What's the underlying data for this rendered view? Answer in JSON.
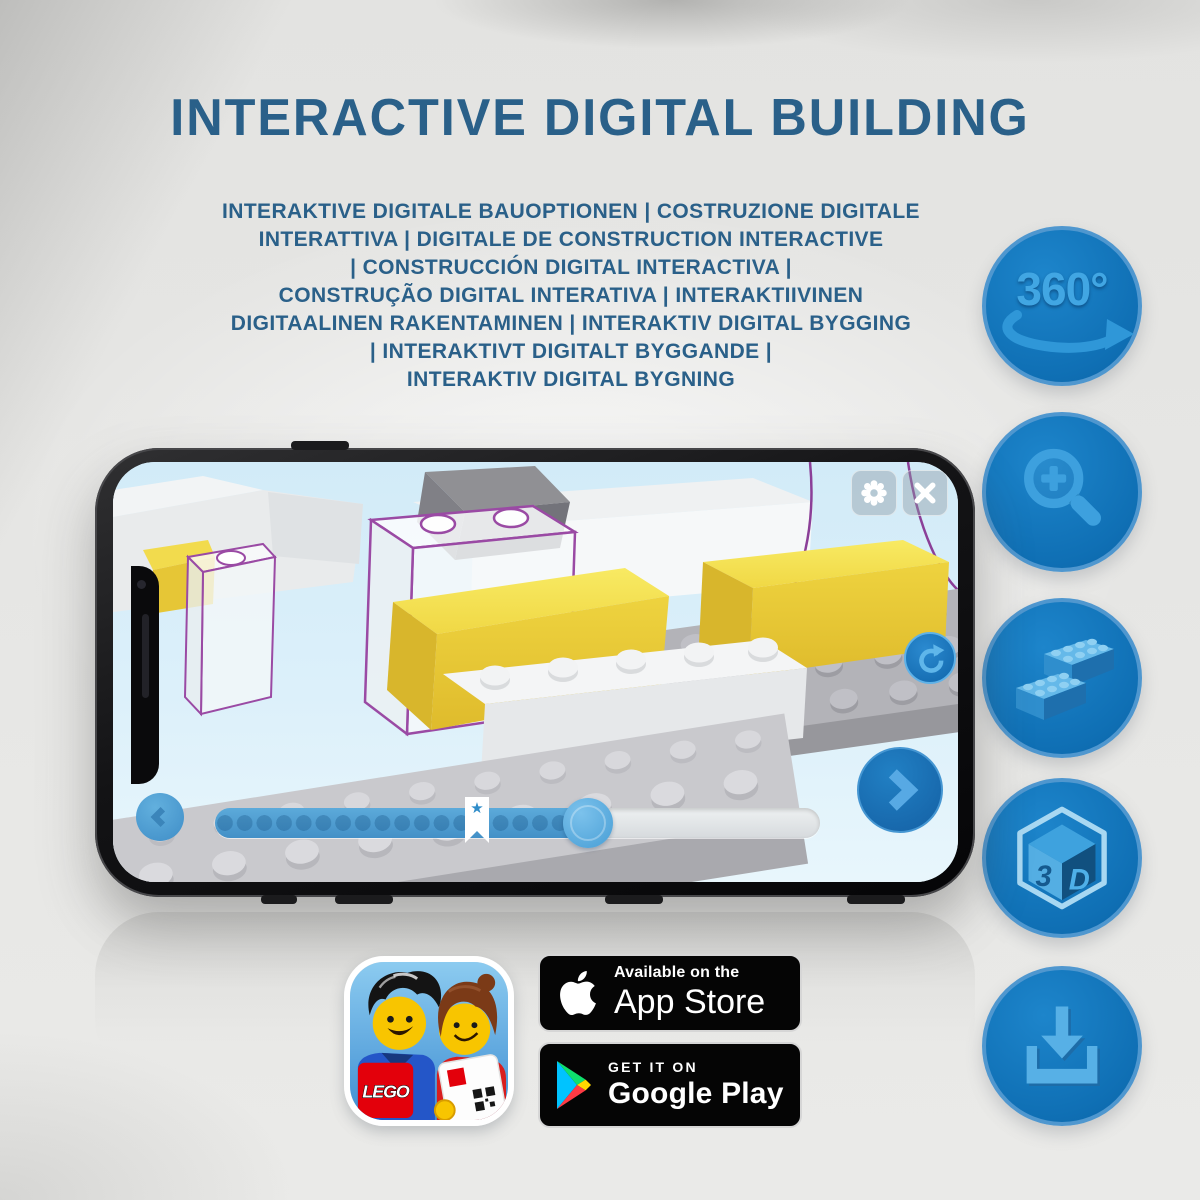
{
  "header": {
    "title": "INTERACTIVE DIGITAL BUILDING",
    "title_color": "#2a6089",
    "subtitle_lines": [
      "INTERAKTIVE DIGITALE BAUOPTIONEN | COSTRUZIONE DIGITALE",
      "INTERATTIVA | DIGITALE DE CONSTRUCTION INTERACTIVE",
      "| CONSTRUCCIÓN DIGITAL INTERACTIVA |",
      "CONSTRUÇÃO DIGITAL INTERATIVA | INTERAKTIIVINEN",
      "DIGITAALINEN RAKENTAMINEN | INTERAKTIV DIGITAL BYGGING",
      "| INTERAKTIVT DIGITALT BYGGANDE |",
      "INTERAKTIV DIGITAL BYGNING"
    ]
  },
  "features": {
    "circle_color": "#1173b9",
    "icon_color": "#3da0de",
    "items": [
      {
        "name": "360-rotation-icon",
        "label": "360°"
      },
      {
        "name": "zoom-in-icon"
      },
      {
        "name": "lego-bricks-icon"
      },
      {
        "name": "3d-cube-icon",
        "face_left": "3",
        "face_right": "D"
      },
      {
        "name": "download-icon"
      }
    ]
  },
  "phone": {
    "screen": {
      "icons": {
        "settings": "gear",
        "close": "x-cross",
        "rotate_view": "circular-arrow",
        "previous_step": "chevron-left",
        "next_step": "chevron-right"
      },
      "progress": {
        "filled_percent": 62,
        "bookmark_percent": 42,
        "star_glyph": "★"
      },
      "scene_colors": {
        "screen_blue": "#d7edf9",
        "lego_yellow": "#f2d945",
        "ghost_outline_purple": "#9a4aa4",
        "baseplate_gray": "#c9c9cd"
      }
    }
  },
  "store": {
    "app_icon": {
      "logo_text": "LEGO"
    },
    "app_store": {
      "tagline": "Available on the",
      "name": "App Store"
    },
    "google_play": {
      "tagline": "GET IT ON",
      "name": "Google Play"
    }
  }
}
